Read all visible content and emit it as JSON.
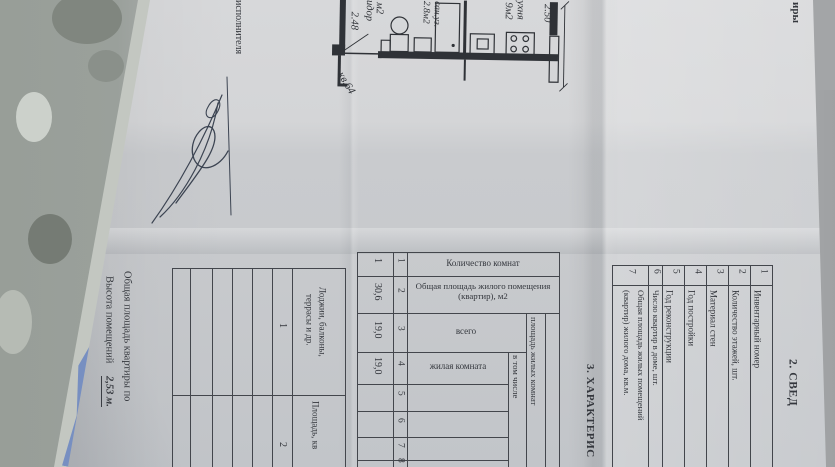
{
  "photo_colors": {
    "paper": "#cccdd0",
    "ink": "#34373d",
    "plastic": "#9aa19a",
    "blue_mark": "#5d7cc0"
  },
  "top_fragment": {
    "text": "иры"
  },
  "executor": {
    "label": "исполнителя"
  },
  "plan": {
    "apartment_no": "кв.64",
    "corridor_label": "коридор",
    "corridor_area": "м2",
    "corridor_dim": "2.48",
    "bath_label": "сан.уз.",
    "bath_area": "2.8м2",
    "kitchen_label": "кухня",
    "kitchen_area": "9м2",
    "kitchen_dim": "2.50"
  },
  "section2": {
    "title": "2. СВЕД",
    "rows": [
      {
        "num": "1",
        "label": "Инвентарный номер"
      },
      {
        "num": "2",
        "label": "Количество этажей, шт."
      },
      {
        "num": "3",
        "label": "Материал стен"
      },
      {
        "num": "4",
        "label": "Год постройки"
      },
      {
        "num": "5",
        "label": "Год реконструкции"
      },
      {
        "num": "6",
        "label": "Число квартир в доме, шт."
      },
      {
        "num": "7",
        "label": "Общая площадь жилых помещений",
        "label2": "(квартир) жилого дома, кв.м."
      }
    ]
  },
  "section3": {
    "title": "3. ХАРАКТЕРИС",
    "group_header_1": "площадь жилых комнат",
    "group_header_2": "в том числе",
    "columns": [
      {
        "num": "1",
        "label": "Количество комнат",
        "value": "1"
      },
      {
        "num": "2",
        "label": "Общая площадь жилого помещения (квартир), м2",
        "value": "30,6"
      },
      {
        "num": "3",
        "label": "всего",
        "value": "19,0"
      },
      {
        "num": "4",
        "label": "жилая комната",
        "value": "19,0"
      },
      {
        "num": "5",
        "label": "",
        "value": ""
      },
      {
        "num": "6",
        "label": "",
        "value": ""
      },
      {
        "num": "7",
        "label": "",
        "value": ""
      },
      {
        "num": "8",
        "label": "",
        "value": ""
      }
    ],
    "annex_columns": [
      {
        "num": "1",
        "label_line1": "Лоджии, балконы,",
        "label_line2": "террасы и др."
      },
      {
        "num": "2",
        "label_line1": "Площадь, кв"
      }
    ],
    "notes": {
      "line1": "Общая площадь квартиры по",
      "line2_label": "Высота помещений",
      "line2_value": "2,53 м."
    }
  }
}
